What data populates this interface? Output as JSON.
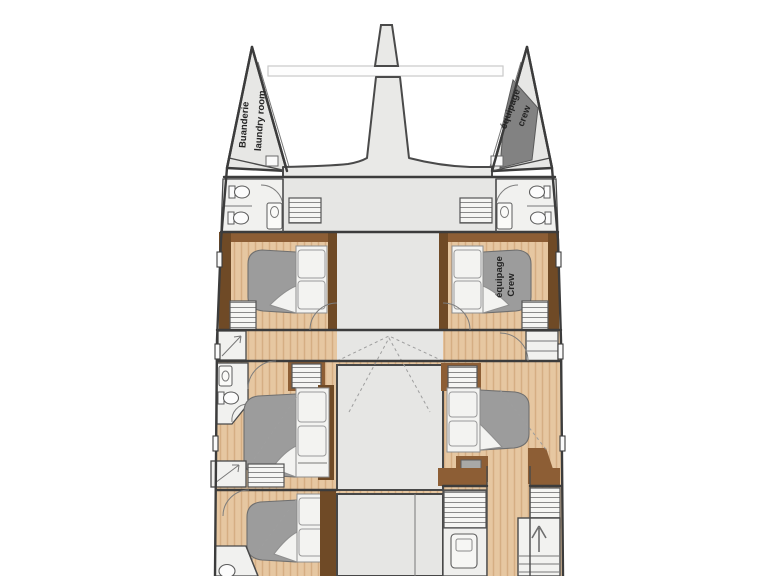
{
  "diagram": {
    "type": "catamaran-deck-floor-plan",
    "labels": {
      "port_bow": {
        "line1": "Buanderie",
        "line2": "laundry room"
      },
      "starboard_bow": {
        "line1": "équipage",
        "line2": "crew"
      },
      "crew_cabin": {
        "line1": "équipage",
        "line2": "Crew"
      }
    }
  },
  "colors": {
    "background": "#ffffff",
    "deck": "#e6e6e4",
    "wood_light": "#e6c7a1",
    "wood_stripe": "#d5ae83",
    "wood_trim": "#8d5e35",
    "wood_trim_dark": "#6f4a26",
    "bed_gray": "#9c9c9c",
    "linen": "#f3f3f1",
    "bathroom": "#f1f1ef",
    "wall": "#3c3c3c",
    "crew_patch": "#828282"
  }
}
